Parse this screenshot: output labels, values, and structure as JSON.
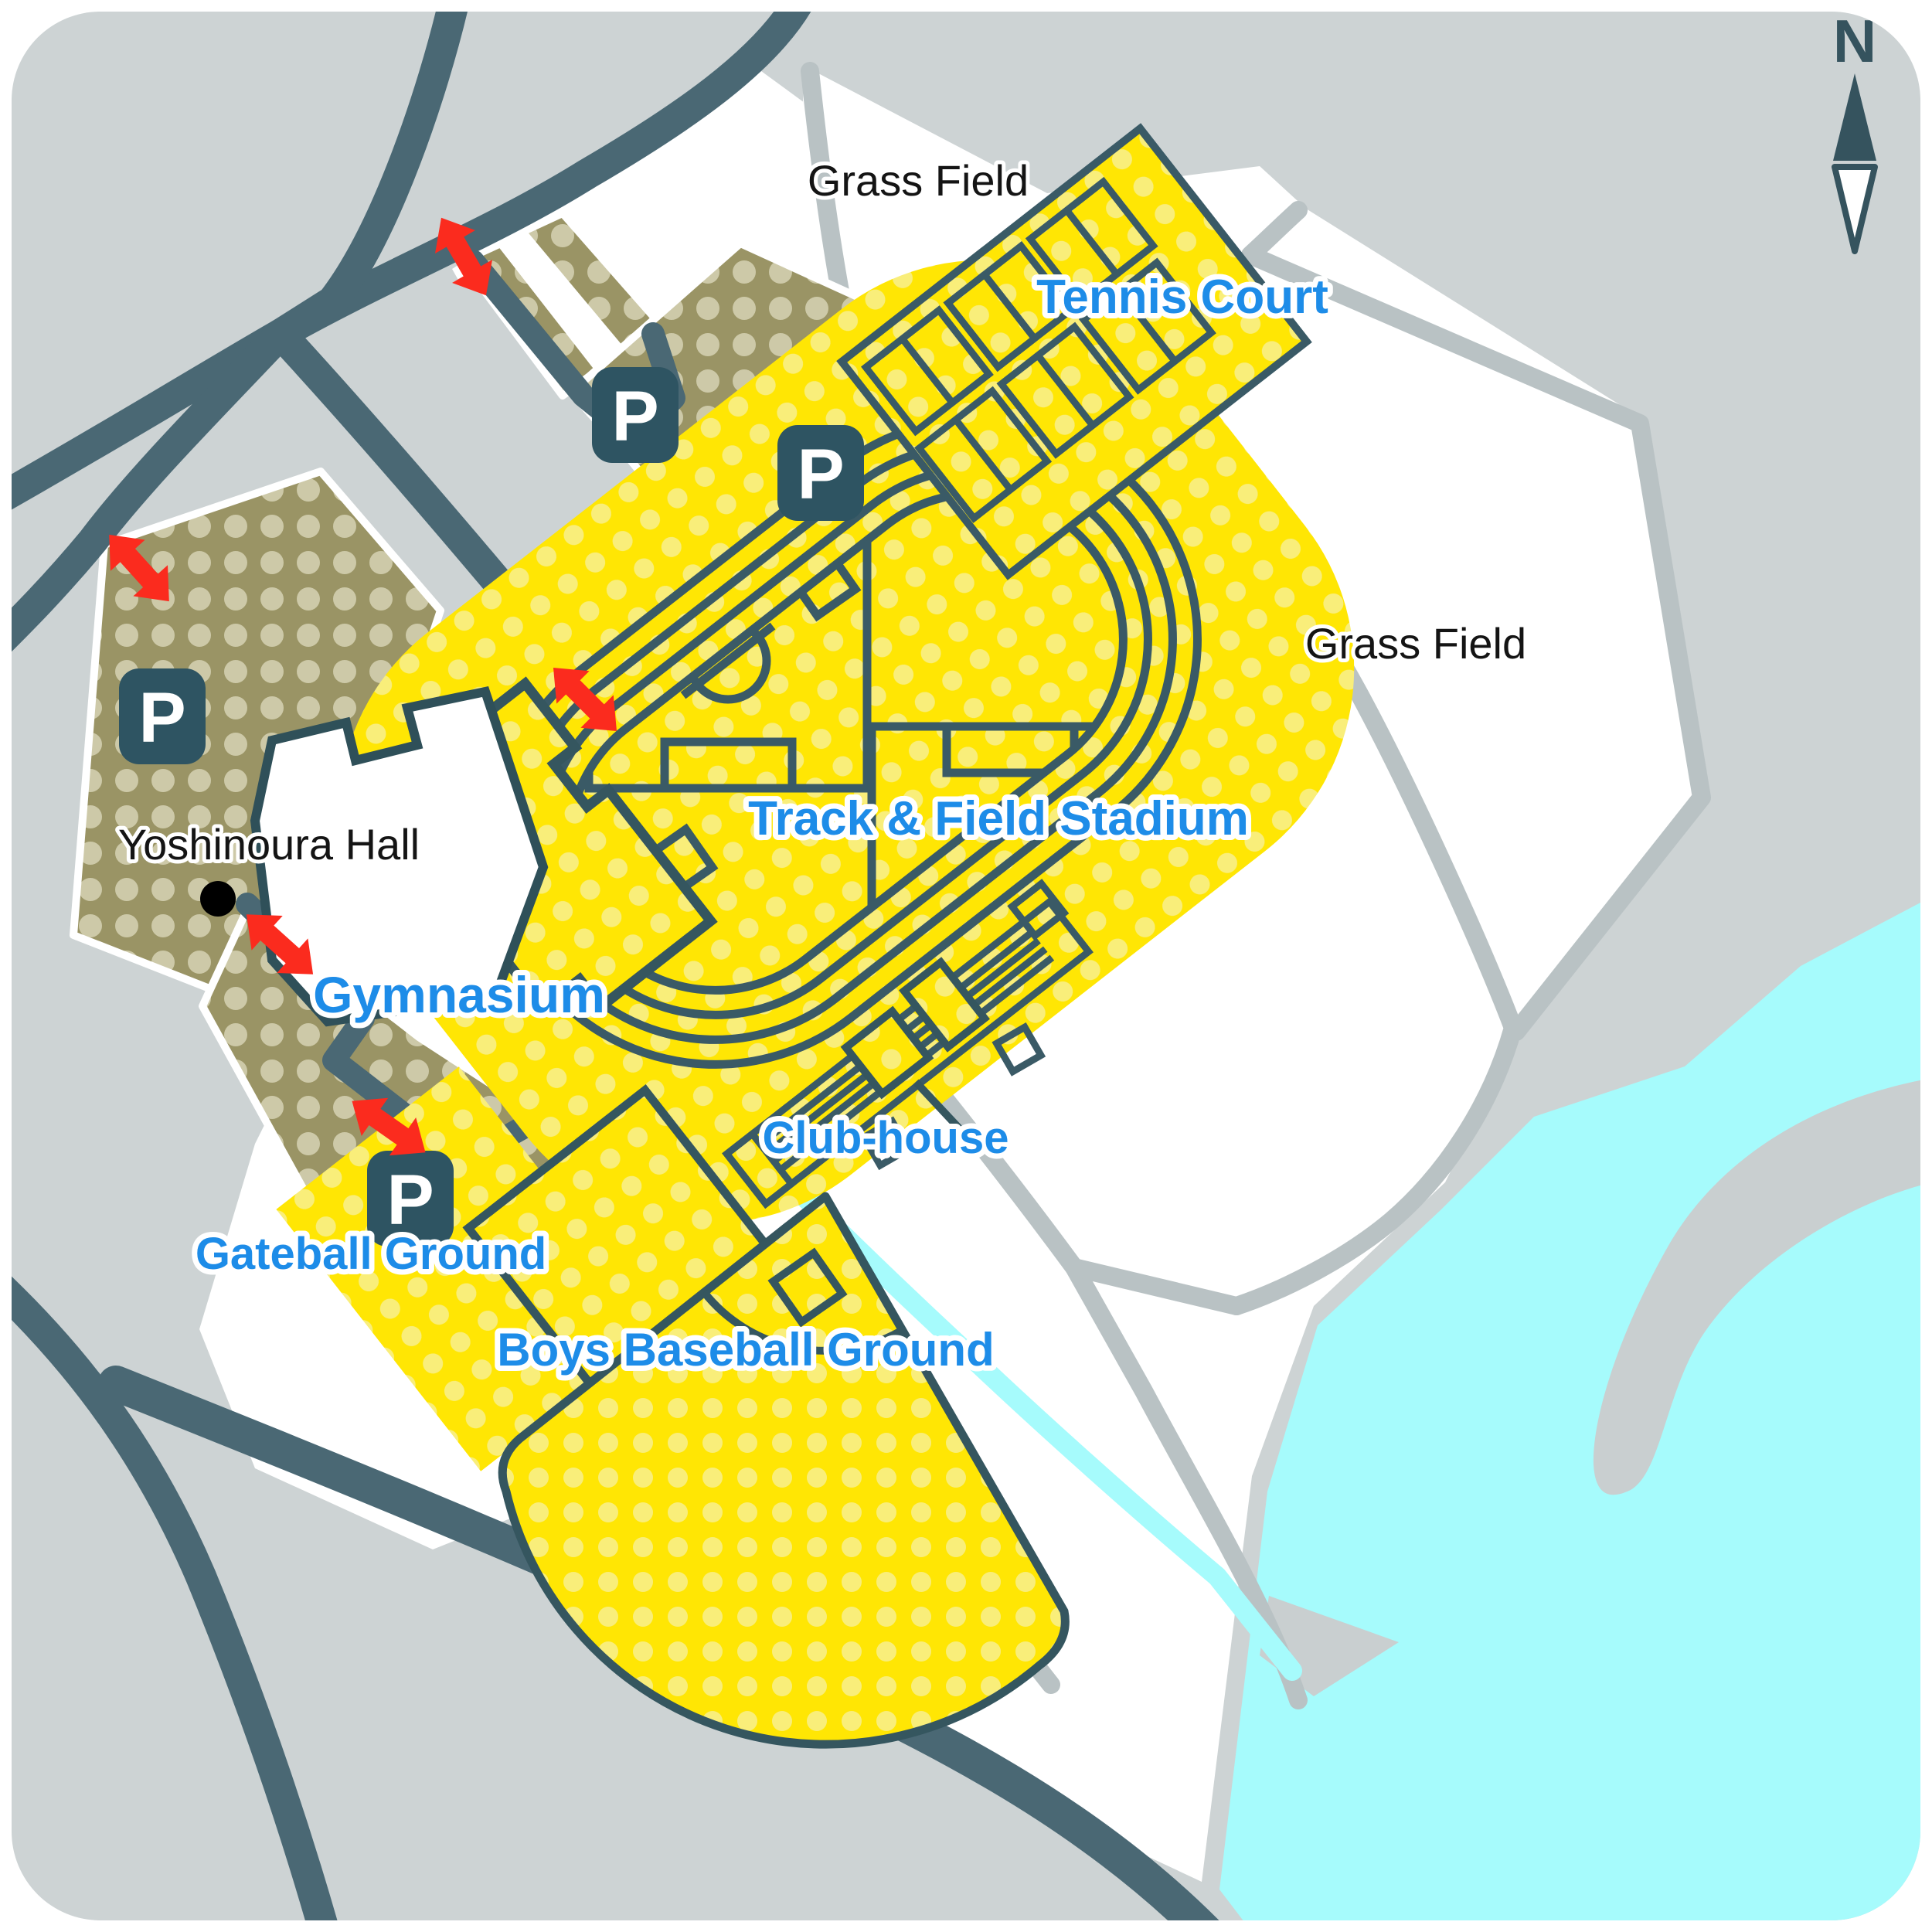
{
  "map": {
    "type": "facility-guide-map",
    "facility_labels": {
      "tennis_court": "Tennis Court",
      "track_field_stadium": "Track & Field Stadium",
      "gymnasium": "Gymnasium",
      "club_house": "Club-house",
      "gateball_ground": "Gateball Ground",
      "boys_baseball_ground": "Boys Baseball Ground"
    },
    "area_labels": {
      "grass_field_north": "Grass Field",
      "grass_field_east": "Grass Field",
      "yoshinoura_hall": "Yoshinoura Hall"
    },
    "icons": {
      "parking_label": "P",
      "parking_icon_count": 4,
      "entrance_arrow_count": 5,
      "compass_label": "N"
    },
    "colors": {
      "background_gray": "#cdd3d4",
      "land_white": "#ffffff",
      "road_dark": "#4a6874",
      "outline_dark": "#3a5a66",
      "road_gray": "#b9c2c4",
      "water_cyan": "#a6fbfc",
      "parking_khaki": "#9a9465",
      "parking_dot": "#cdc9a8",
      "field_yellow": "#ffe604",
      "field_dot": "#f9ee7a",
      "entrance_red": "#fb2b1e",
      "label_blue": "#1d8ce8",
      "icon_slate": "#2e5462"
    }
  }
}
